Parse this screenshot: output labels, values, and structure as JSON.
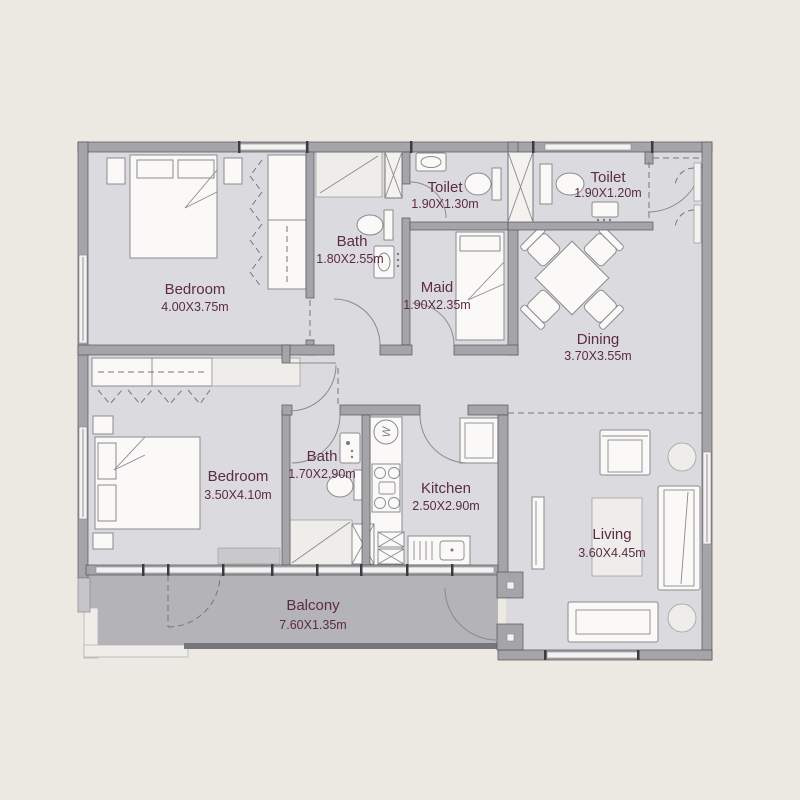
{
  "plan": {
    "type": "apartment-floor-plan",
    "rooms": [
      {
        "id": "bedroom-1",
        "name": "Bedroom",
        "dims": "4.00X3.75m"
      },
      {
        "id": "bath-1",
        "name": "Bath",
        "dims": "1.80X2.55m"
      },
      {
        "id": "toilet-1",
        "name": "Toilet",
        "dims": "1.90X1.30m"
      },
      {
        "id": "maid",
        "name": "Maid",
        "dims": "1.90X2.35m"
      },
      {
        "id": "toilet-2",
        "name": "Toilet",
        "dims": "1.90X1.20m"
      },
      {
        "id": "dining",
        "name": "Dining",
        "dims": "3.70X3.55m"
      },
      {
        "id": "bedroom-2",
        "name": "Bedroom",
        "dims": "3.50X4.10m"
      },
      {
        "id": "bath-2",
        "name": "Bath",
        "dims": "1.70X2.90m"
      },
      {
        "id": "kitchen",
        "name": "Kitchen",
        "dims": "2.50X2.90m"
      },
      {
        "id": "living",
        "name": "Living",
        "dims": "3.60X4.45m"
      },
      {
        "id": "balcony",
        "name": "Balcony",
        "dims": "7.60X1.35m"
      }
    ],
    "appliances": {
      "washer_label": "W"
    },
    "colors": {
      "background": "#ece9e3",
      "floor": "#dbdade",
      "balcony_floor": "#b4b3b7",
      "walls": "#a5a4a8",
      "label_text": "#5c2b47",
      "furniture": "#faf9f7"
    }
  }
}
